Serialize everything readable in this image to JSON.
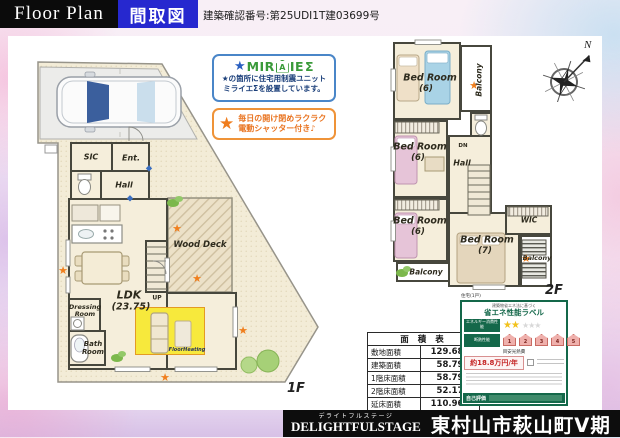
{
  "header": {
    "floor_plan_en": "Floor Plan",
    "floor_plan_jp": "間取図",
    "confirmation": "建築確認番号:第25UDI1T建03699号"
  },
  "badges": {
    "miraie": {
      "star": "★",
      "logo_prefix": "MIR",
      "logo_a": "A",
      "logo_suffix": "IE",
      "logo_sigma": "Σ",
      "line1": "★の箇所に住宅用制震ユニット",
      "line2": "ミライエΣを設置しています。"
    },
    "shutter": {
      "star": "★",
      "line1": "毎日の開け閉めラクラク",
      "line2": "電動シャッター付き♪"
    }
  },
  "floor1": {
    "label": "1F",
    "rooms": {
      "sic": "SIC",
      "ent": "Ent.",
      "hall": "Hall",
      "ldk_name": "LDK",
      "ldk_size": "(23.75)",
      "wood_deck": "Wood Deck",
      "up": "UP",
      "dressing_1": "Dressing",
      "dressing_2": "Room",
      "bath_1": "Bath",
      "bath_2": "Room",
      "floor_heating": "FloorHeating"
    }
  },
  "floor2": {
    "label": "2F",
    "rooms": {
      "bedroom1_name": "Bed Room",
      "bedroom1_size": "(6)",
      "bedroom2_name": "Bed Room",
      "bedroom2_size": "(6)",
      "bedroom3_name": "Bed Room",
      "bedroom3_size": "(6)",
      "bedroom4_name": "Bed Room",
      "bedroom4_size": "(7)",
      "balcony_top": "Balcony",
      "balcony_left": "Balcony",
      "balcony_right": "Balcony",
      "wic": "WIC",
      "hall": "Hall",
      "dn": "DN"
    }
  },
  "compass": {
    "north": "N"
  },
  "area_table": {
    "title": "面 積 表",
    "rows": [
      {
        "label": "敷地面積",
        "value": "129.68m²"
      },
      {
        "label": "建築面積",
        "value": "58.79m²"
      },
      {
        "label": "1階床面積",
        "value": "58.79m²"
      },
      {
        "label": "2階床面積",
        "value": "52.17m²"
      },
      {
        "label": "延床面積",
        "value": "110.96m²"
      }
    ]
  },
  "energy_label": {
    "type_note": "住宅(1戸)",
    "law_note": "建築物省エネ法に基づく",
    "title": "省エネ性能ラベル",
    "energy_row_label": "エネルギー消費性能",
    "insulation_row_label": "断熱性能",
    "stars_filled": "★★",
    "stars_empty": "★★★",
    "scale": [
      "1",
      "2",
      "3",
      "4",
      "5"
    ],
    "cost_section_label": "目安光熱費",
    "cost_value": "約18.8万円/年",
    "self_eval_label": "自己評価"
  },
  "footer": {
    "furigana": "デライトフルステージ",
    "brand": "DELIGHTFULSTAGE",
    "project": "東村山市萩山町Ⅴ期"
  },
  "icons": {
    "star": "★"
  },
  "colors": {
    "accent_blue": "#2628cf",
    "star_orange": "#f07f1e",
    "energy_green": "#14684a"
  }
}
